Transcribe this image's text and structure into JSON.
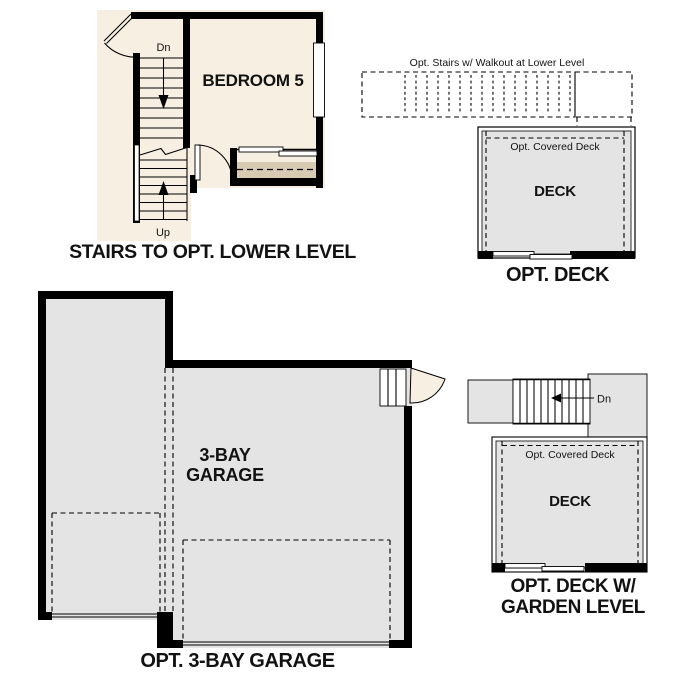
{
  "colors": {
    "beige": "#f6efe2",
    "tan": "#d7ccb3",
    "gray": "#e4e4e4",
    "wall": "#000000"
  },
  "plans": {
    "stairs_lower_level": {
      "caption": "STAIRS TO OPT. LOWER LEVEL",
      "room_label": "BEDROOM 5",
      "stairs_down_label": "Dn",
      "stairs_up_label": "Up"
    },
    "opt_deck": {
      "caption": "OPT. DECK",
      "stairs_note": "Opt. Stairs w/ Walkout at Lower Level",
      "covered_deck_label": "Opt. Covered Deck",
      "deck_label": "DECK"
    },
    "garage": {
      "caption": "OPT. 3-BAY GARAGE",
      "room_label_line1": "3-BAY",
      "room_label_line2": "GARAGE"
    },
    "deck_garden": {
      "caption": "OPT. DECK W/\nGARDEN LEVEL",
      "stairs_down_label": "Dn",
      "covered_deck_label": "Opt. Covered Deck",
      "deck_label": "DECK"
    }
  }
}
